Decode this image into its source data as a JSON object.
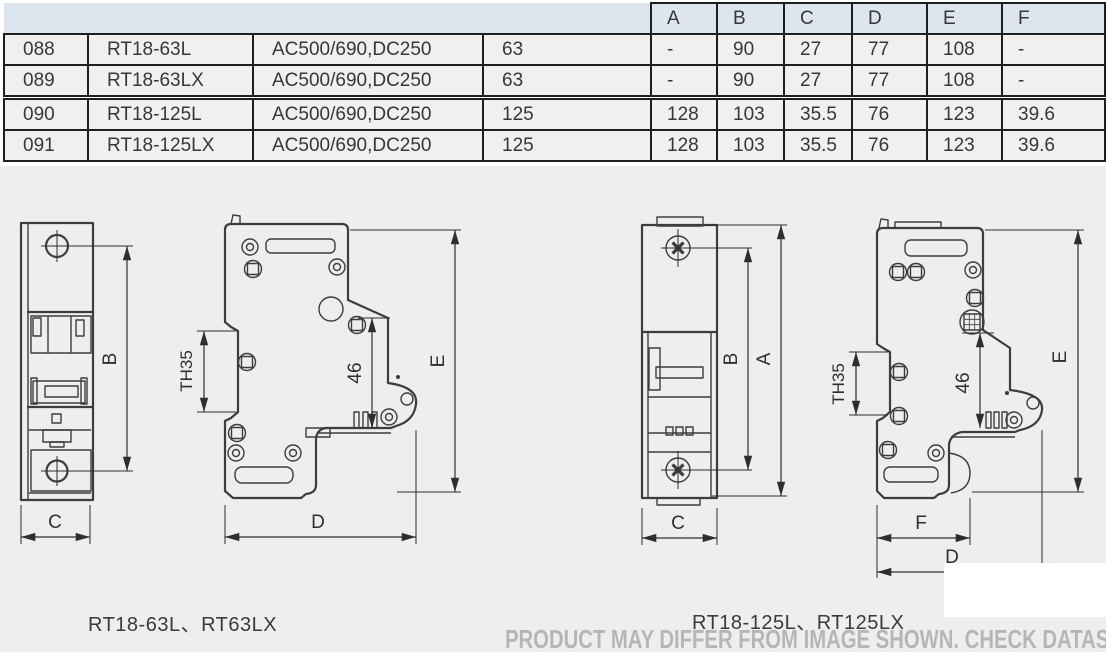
{
  "table": {
    "dim_headers": [
      "A",
      "B",
      "C",
      "D",
      "E",
      "F"
    ],
    "rows": [
      {
        "no": "088",
        "model": "RT18-63L",
        "voltage": "AC500/690,DC250",
        "current": "63",
        "dims": [
          "-",
          "90",
          "27",
          "77",
          "108",
          "-"
        ]
      },
      {
        "no": "089",
        "model": "RT18-63LX",
        "voltage": "AC500/690,DC250",
        "current": "63",
        "dims": [
          "-",
          "90",
          "27",
          "77",
          "108",
          "-"
        ]
      },
      {
        "no": "090",
        "model": "RT18-125L",
        "voltage": "AC500/690,DC250",
        "current": "125",
        "dims": [
          "128",
          "103",
          "35.5",
          "76",
          "123",
          "39.6"
        ]
      },
      {
        "no": "091",
        "model": "RT18-125LX",
        "voltage": "AC500/690,DC250",
        "current": "125",
        "dims": [
          "128",
          "103",
          "35.5",
          "76",
          "123",
          "39.6"
        ]
      }
    ]
  },
  "drawings": {
    "left": {
      "caption": "RT18-63L、RT63LX",
      "labels": {
        "b": "B",
        "c": "C",
        "th35": "TH35",
        "mid": "46",
        "e": "E",
        "d": "D"
      }
    },
    "right": {
      "caption": "RT18-125L、RT125LX",
      "labels": {
        "a": "A",
        "b": "B",
        "c": "C",
        "th35": "TH35",
        "mid": "46",
        "e": "E",
        "f": "F",
        "d": "D"
      }
    }
  },
  "watermark": "PRODUCT MAY DIFFER FROM IMAGE SHOWN. CHECK DATASHEET.",
  "colors": {
    "header_bg": "#dde5ef",
    "cell_bg": "#f1f0ee",
    "canvas_bg": "#efeeec",
    "line": "#3d3d3d",
    "border": "#1f1f1f",
    "watermark": "#b4b7b9"
  }
}
